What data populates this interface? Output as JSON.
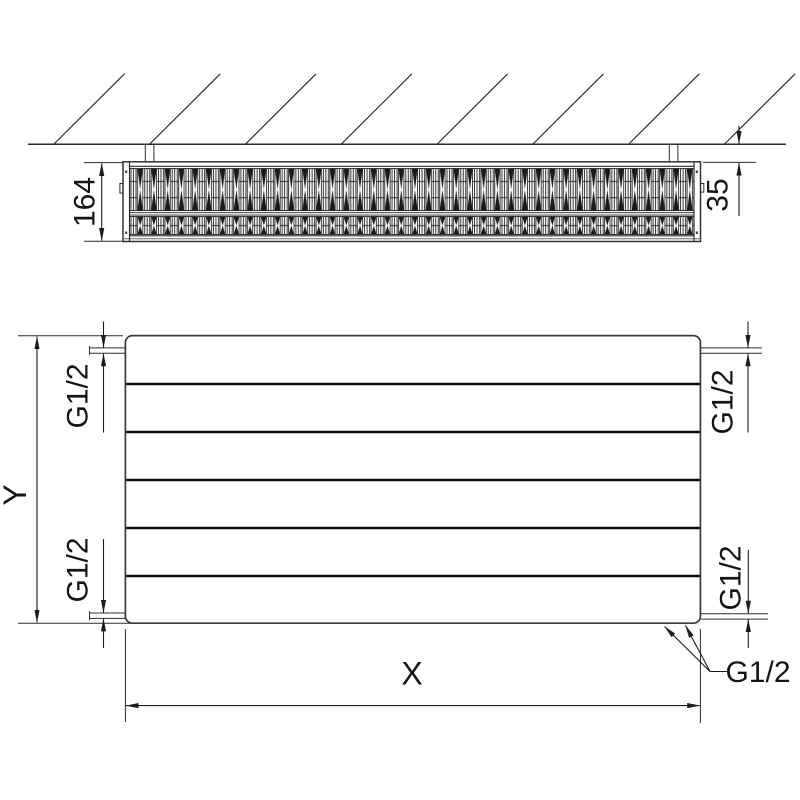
{
  "drawing": {
    "type": "radiator-technical-drawing",
    "background": "#ffffff",
    "line_color": "#2b2b2b"
  },
  "top_view": {
    "depth_dimension": "164",
    "wall_distance_dimension": "35"
  },
  "front_view": {
    "height_dimension": "Y",
    "width_dimension": "X",
    "groove_count": 5,
    "connection_top_left": "G1/2",
    "connection_bottom_left": "G1/2",
    "connection_top_right": "G1/2",
    "connection_bottom_right": "G1/2",
    "connection_bottom_label": "G1/2"
  }
}
